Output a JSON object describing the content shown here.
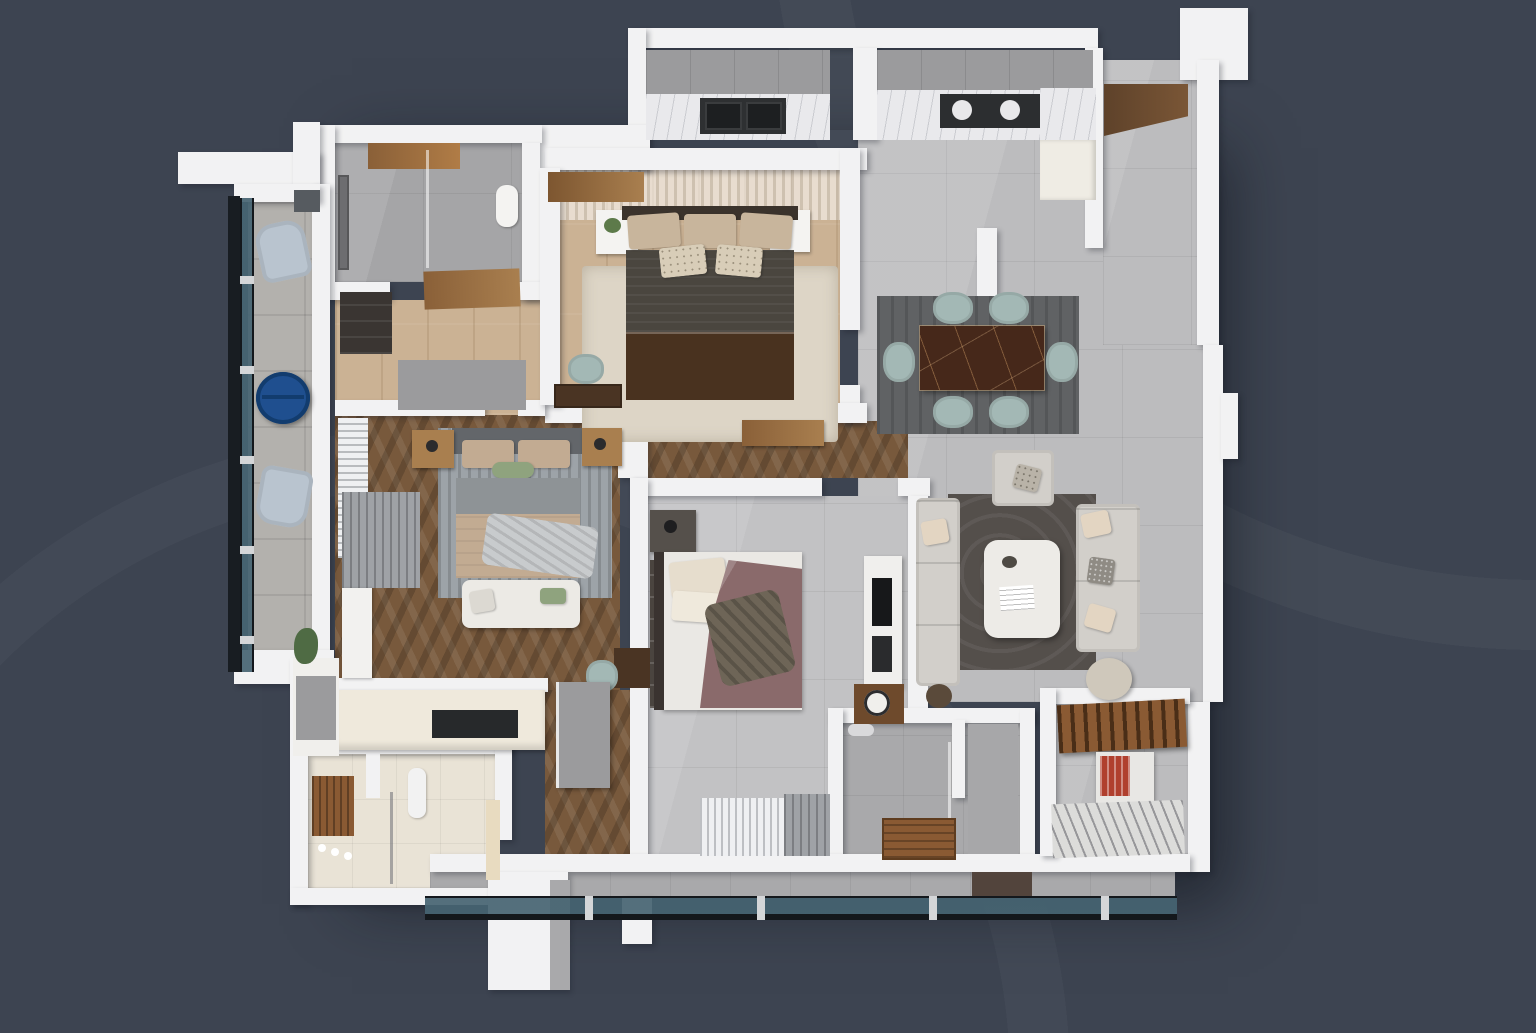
{
  "meta": {
    "type": "3d-apartment-floor-plan-render",
    "view": "top-down-cutaway",
    "width_px": 1536,
    "height_px": 1033,
    "visible_text": ""
  },
  "palette": {
    "bg": "#3d4451",
    "wall": "#f2f2f3",
    "wall-shade": "#d6d6d8",
    "tile-gray": "#bcbcbe",
    "tile-gray-dark": "#a9a9ab",
    "tile-cream": "#e9e3d6",
    "wood-light": "#cbb294",
    "wood-mid": "#a97f4f",
    "wood-dark": "#6f5238",
    "herringbone": "#78593c",
    "glass-frame": "#14181c",
    "marble-counter": "#e9e9ec",
    "cabinet-gray": "#9b9b9d",
    "sink-dark": "#2e3032",
    "dining-table": "#46281a",
    "chair-sage": "#a3b8b5",
    "rug-dark": "#606264",
    "rug-living": "#544f4b",
    "rug-cream": "#ddd5c6",
    "rug-gray": "#9da3a8",
    "sofa-light": "#d2cfca",
    "pillow-beige": "#c8b59c",
    "bed-dark": "#4a463f",
    "bed-brown": "#49321f",
    "bed-beige": "#c2ab92",
    "bed-gray": "#8e9396",
    "bed-mauve": "#8a6a6b",
    "bed-white": "#eae8e4",
    "green-pillow": "#8fa37e",
    "curtain-white": "#eff0f2",
    "curtain-gray": "#9fa2a6",
    "table-blue": "#1f4f8f",
    "chair-blue": "#b9c4cf",
    "wood-slat": "#8a5a33",
    "stone": "#b3b1ad",
    "headboard-dark": "#3b332c",
    "headboard-gray": "#63666a",
    "books-red": "#b0402e"
  },
  "rooms": [
    {
      "name": "bathroom-1",
      "position": "top-left",
      "floor": "gray-tile",
      "features": [
        "walk-in-shower",
        "glass-partition",
        "wall-shower-panel",
        "toilet",
        "wood-ceiling-panel"
      ]
    },
    {
      "name": "dressing-hall",
      "position": "left-center",
      "floor": "light-oak-wood",
      "features": [
        "dark-wardrobe",
        "wood-door-panel",
        "gray-partition"
      ]
    },
    {
      "name": "master-bedroom",
      "position": "top-center",
      "floor": "light-oak-wood",
      "features": [
        "double-bed-dark-blanket",
        "brown-lower-blanket",
        "beige-pillows",
        "white-nightstand-left-with-plant",
        "white-nightstand-right",
        "cream-rug",
        "desk",
        "teal-desk-chair",
        "white-slatted-ceiling",
        "wood-beam"
      ]
    },
    {
      "name": "kitchen",
      "position": "top",
      "floor": "gray-tile",
      "features": [
        "marble-countertop",
        "gray-upper-cabinets",
        "double-dark-sink",
        "two-burner-cooktop",
        "tall-cream-cabinet"
      ]
    },
    {
      "name": "entry-hall",
      "position": "top-right",
      "floor": "gray-tile",
      "features": [
        "dark-wood-ceiling-strip"
      ]
    },
    {
      "name": "dining-area",
      "position": "center-right",
      "floor": "gray-tile",
      "features": [
        "brown-marble-dining-table",
        "six-sage-green-chairs",
        "dark-gray-rug"
      ]
    },
    {
      "name": "living-room",
      "position": "right",
      "floor": "gray-tile",
      "features": [
        "light-gray-sofa-left",
        "light-gray-sofa-right",
        "armchair",
        "white-coffee-table-with-magazine",
        "dark-swirl-rug",
        "round-side-table",
        "tv-media-column",
        "plant"
      ]
    },
    {
      "name": "bedroom-2",
      "position": "center-left",
      "floor": "dark-herringbone-wood",
      "features": [
        "bed-beige-blanket",
        "gray-headboard",
        "wood-nightstands-with-lamps",
        "green-pillow",
        "striped-gray-rug",
        "white-bench-at-foot",
        "white-curtains",
        "gray-curtains",
        "white-wardrobe",
        "small-desk",
        "teal-chair"
      ]
    },
    {
      "name": "bedroom-3",
      "position": "bottom-center",
      "floor": "gray-tile",
      "features": [
        "bed-white-sheets",
        "mauve-draped-blanket",
        "cream-pillows",
        "dark-nightstand-with-lamp",
        "gray-wardrobe",
        "brown-clock-cabinet",
        "white-and-gray-window-curtains"
      ]
    },
    {
      "name": "shower-room",
      "position": "bottom-center-right",
      "floor": "gray-tile",
      "features": [
        "glass-partition",
        "wood-floor-mat",
        "shower-head",
        "dark-doormat"
      ]
    },
    {
      "name": "bathroom-2",
      "position": "bottom-left",
      "floor": "cream-tile",
      "features": [
        "wood-wall-panel",
        "glass-partition",
        "wall-fixtures",
        "towel-rail"
      ]
    },
    {
      "name": "kitchenette",
      "position": "bottom-left-center",
      "floor": "cream",
      "features": [
        "l-shaped-cream-counter",
        "black-cooktop",
        "gray-fronted-cabinet"
      ]
    },
    {
      "name": "utility-room",
      "position": "bottom-right",
      "floor": "gray-tile",
      "features": [
        "wood-slat-shelf",
        "cabinet-with-red-books",
        "floor-drying-rack"
      ]
    },
    {
      "name": "side-balcony",
      "position": "left",
      "floor": "stone-tile",
      "features": [
        "glass-railing-with-clamps",
        "two-pale-blue-lounge-chairs",
        "cobalt-blue-round-table",
        "plant",
        "vent"
      ]
    },
    {
      "name": "bottom-balcony",
      "position": "bottom",
      "floor": "gray-tile",
      "features": [
        "glass-railing-with-clamps"
      ]
    }
  ]
}
